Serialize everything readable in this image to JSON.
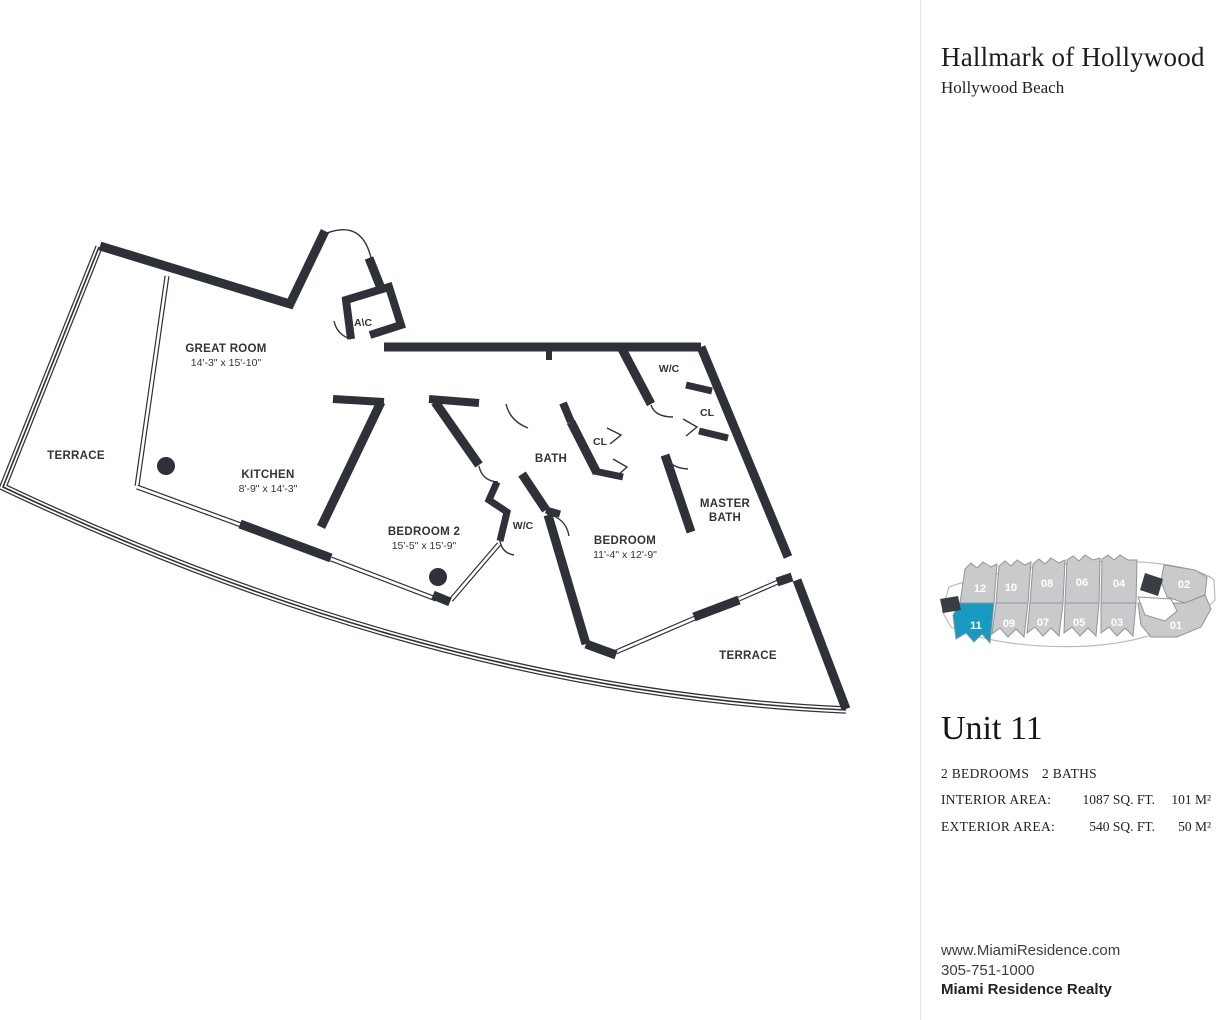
{
  "header": {
    "title": "Hallmark of Hollywood",
    "subtitle": "Hollywood Beach"
  },
  "floor_plan": {
    "rooms": {
      "terrace_left": {
        "label": "TERRACE"
      },
      "great_room": {
        "label": "GREAT ROOM",
        "dims": "14'-3\" x 15'-10\""
      },
      "kitchen": {
        "label": "KITCHEN",
        "dims": "8'-9\" x 14'-3\""
      },
      "ac": {
        "label": "A\\C"
      },
      "bedroom2": {
        "label": "BEDROOM 2",
        "dims": "15'-5\" x 15'-9\""
      },
      "wc_bedroom2": {
        "label": "W/C"
      },
      "bath": {
        "label": "BATH"
      },
      "cl_bath": {
        "label": "CL"
      },
      "wc_master": {
        "label": "W/C"
      },
      "cl_master": {
        "label": "CL"
      },
      "master_bath": {
        "line1": "MASTER",
        "line2": "BATH"
      },
      "bedroom": {
        "label": "BEDROOM",
        "dims": "11'-4\" x 12'-9\""
      },
      "terrace_right": {
        "label": "TERRACE"
      }
    },
    "wall_color": "#2e3138"
  },
  "keyplan": {
    "highlight_color": "#1799c1",
    "unit_fill": "#c9cacb",
    "highlighted_unit": "11",
    "units": [
      {
        "label": "12"
      },
      {
        "label": "10"
      },
      {
        "label": "08"
      },
      {
        "label": "06"
      },
      {
        "label": "04"
      },
      {
        "label": "02"
      },
      {
        "label": "11"
      },
      {
        "label": "09"
      },
      {
        "label": "07"
      },
      {
        "label": "05"
      },
      {
        "label": "03"
      },
      {
        "label": "01"
      }
    ]
  },
  "unit_info": {
    "name": "Unit 11",
    "bedrooms": "2 BEDROOMS",
    "baths": "2 BATHS",
    "interior_label": "INTERIOR AREA:",
    "interior_sqft": "1087 SQ. FT.",
    "interior_m2": "101 M²",
    "exterior_label": "EXTERIOR AREA:",
    "exterior_sqft": "540 SQ. FT.",
    "exterior_m2": "50 M²"
  },
  "contact": {
    "website": "www.MiamiResidence.com",
    "phone": "305-751-1000",
    "company": "Miami Residence Realty"
  }
}
